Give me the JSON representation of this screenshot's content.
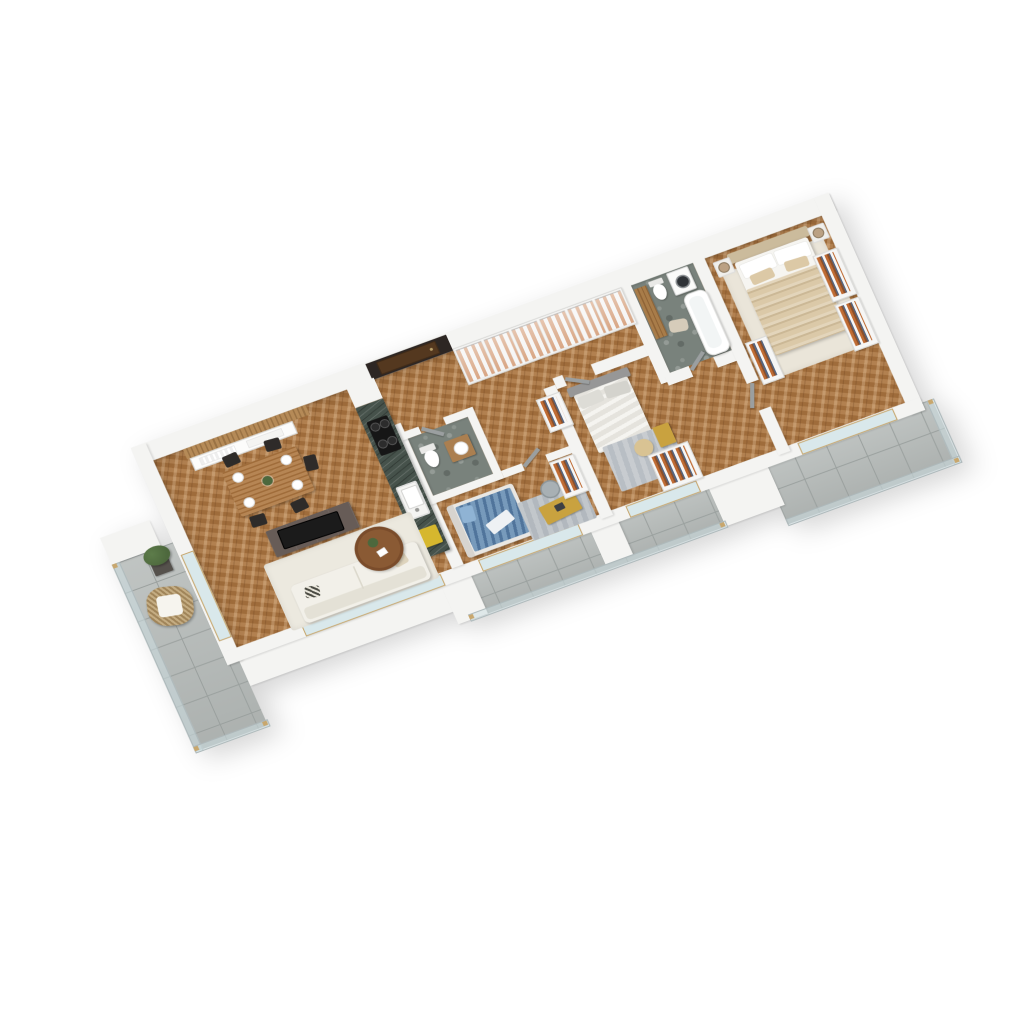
{
  "meta": {
    "kind": "3d-isometric-floorplan-render",
    "view": "axonometric top-down, long axis rotated ~-21deg",
    "background": "#ffffff",
    "visible_text": []
  },
  "palette": {
    "wall": "#f4f4f2",
    "wood_floor": "#a97440",
    "tile": "#b7bcba",
    "stone": "#79827c",
    "marble_counter": "#46524b",
    "entry_wall": "#2d2623",
    "door_entry": "#54381f",
    "clothes_orange": "#bf6b33",
    "bed_blue": "#5d87ae",
    "bed_beige": "#dbc9a8",
    "gold": "#c9a23f",
    "sofa": "#f2f0e9",
    "tv_stand": "#675c57",
    "table_wood": "#a9743f",
    "coffee_table": "#8a5a34",
    "glass": "#cfdfe2",
    "rail_wood": "#c8a76e",
    "plant": "#4d683d",
    "rug_light": "#ece9df",
    "rug_gray": "#c6cacd",
    "headboard_gray": "#979797",
    "wicker": "#b79b6d"
  },
  "rooms": [
    {
      "name": "living-room",
      "floor": "herringbone-wood",
      "furniture": [
        "sofa-white",
        "striped-pillow",
        "beige-pillow",
        "coffee-table-round",
        "table-plant",
        "tv-stand-dark",
        "tv-flat",
        "area-rug-light",
        "sideboard-white",
        "wood-slat-wall-panel"
      ]
    },
    {
      "name": "dining-area",
      "floor": "herringbone-wood",
      "furniture": [
        "dining-table-wood",
        "black-chair x5",
        "place-setting x4",
        "centerpiece-plant"
      ]
    },
    {
      "name": "kitchen",
      "floor": "herringbone-wood",
      "furniture": [
        "marble-counter-run",
        "induction-hob-4-burner",
        "sink-white",
        "faucet",
        "yellow-stool",
        "white-tall-cabinet"
      ]
    },
    {
      "name": "hallway",
      "floor": "herringbone-wood",
      "furniture": [
        "entry-door-dark-brown",
        "dark-entry-wall-panel",
        "glass-wardrobe-6-doors-orange-clothes"
      ]
    },
    {
      "name": "wc",
      "floor": "dark-stone",
      "furniture": [
        "toilet",
        "wood-vanity-with-sink"
      ]
    },
    {
      "name": "kids-bedroom",
      "floor": "herringbone-wood",
      "furniture": [
        "bed-blue-duvet",
        "pillow-blue",
        "desk-gold",
        "desk-chair-gray",
        "rug-gray",
        "open-wardrobe-clothes"
      ]
    },
    {
      "name": "middle-bedroom",
      "floor": "herringbone-wood",
      "furniture": [
        "single-bed-gray-headboard",
        "gray-pillows x2",
        "gold-shelf-caddy",
        "pouf-beige",
        "rug-gray",
        "open-wardrobe-clothes x2"
      ]
    },
    {
      "name": "bathroom",
      "floor": "green-gray-stone",
      "furniture": [
        "bathtub",
        "wall-hung-toilet",
        "washing-machine",
        "tall-wood-cabinet",
        "bath-rug"
      ]
    },
    {
      "name": "master-bedroom",
      "floor": "herringbone-wood",
      "furniture": [
        "double-bed-beige-duvet",
        "upholstered-headboard",
        "white-pillows x2",
        "beige-pillows x2",
        "nightstand x2",
        "table-lamp x2",
        "area-rug-white",
        "open-wardrobe-clothes x3"
      ]
    },
    {
      "name": "balcony-left",
      "floor": "concrete-tile",
      "furniture": [
        "wicker-armchair-white-cushion",
        "planter-green-bush",
        "glass-railing-wood-posts"
      ]
    },
    {
      "name": "balcony-bottom",
      "floor": "concrete-tile",
      "furniture": [
        "glass-railing"
      ]
    },
    {
      "name": "balcony-right",
      "floor": "concrete-tile",
      "furniture": [
        "glass-railing"
      ]
    }
  ]
}
